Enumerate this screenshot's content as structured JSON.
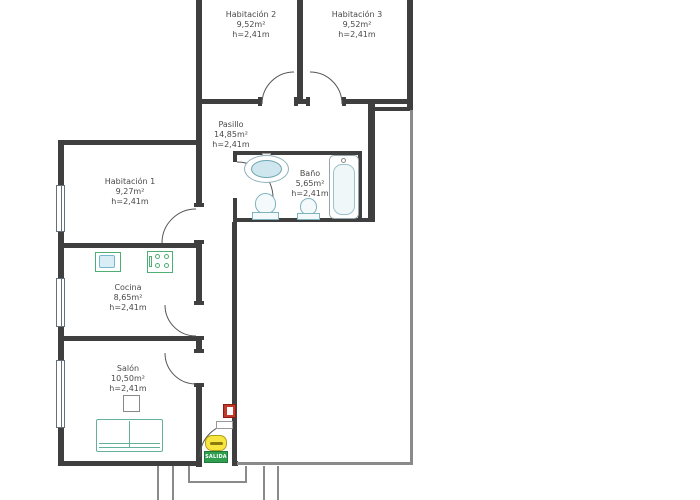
{
  "plan": {
    "rooms": [
      {
        "name": "Habitación 2",
        "area": "9,52m²",
        "height": "h=2,41m"
      },
      {
        "name": "Habitación 3",
        "area": "9,52m²",
        "height": "h=2,41m"
      },
      {
        "name": "Pasillo",
        "area": "14,85m²",
        "height": "h=2,41m"
      },
      {
        "name": "Habitación 1",
        "area": "9,27m²",
        "height": "h=2,41m"
      },
      {
        "name": "Baño",
        "area": "5,65m²",
        "height": "h=2,41m"
      },
      {
        "name": "Cocina",
        "area": "8,65m²",
        "height": "h=2,41m"
      },
      {
        "name": "Salón",
        "area": "10,50m²",
        "height": "h=2,41m"
      }
    ],
    "exit_sign": {
      "label": "SALIDA"
    },
    "colors": {
      "wall": "#3f3f3f",
      "thin_wall": "#8a8a8a",
      "fixture_teal": "#7fb3be",
      "appliance_green": "#4fae74",
      "sofa_green": "#63b09c",
      "exit_green": "#2f9e4f",
      "mat_yellow": "#f6e63f",
      "alarm_red": "#c0392b",
      "text": "#4a4a4a"
    }
  }
}
